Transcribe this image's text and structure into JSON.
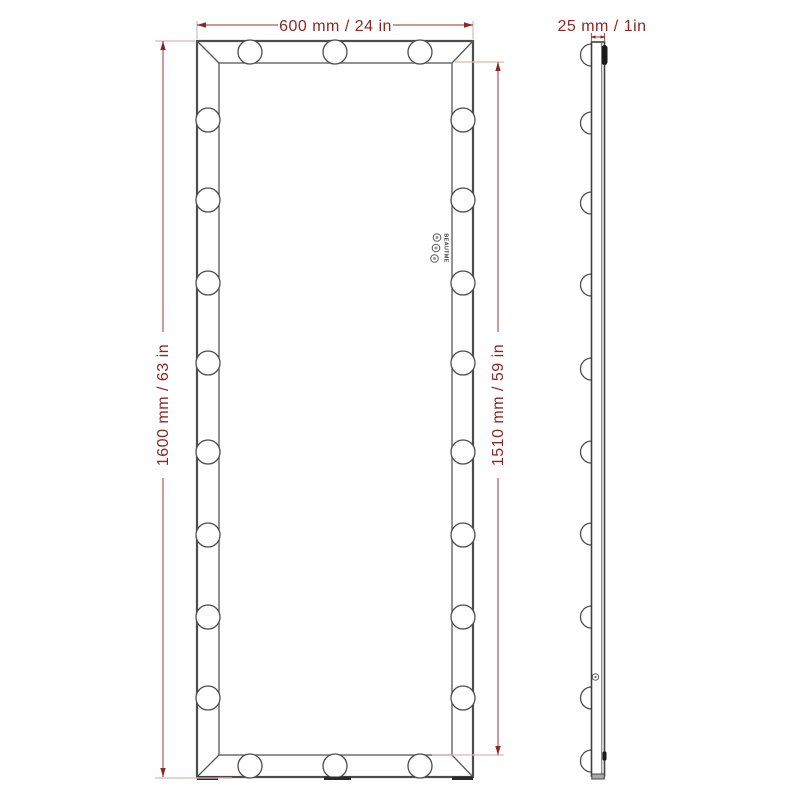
{
  "diagram": {
    "description": "Full-length lighted vanity mirror dimension drawing, front and side views",
    "front_view": {
      "width_label": "600 mm / 24 in",
      "height_label": "1600 mm / 63 in",
      "inner_height_label": "1510 mm / 59 in",
      "brand_label": "BEAUTME",
      "control_button_count": 3,
      "bulbs": {
        "top": 3,
        "bottom": 3,
        "left": 8,
        "right": 8
      }
    },
    "side_view": {
      "depth_label": "25 mm / 1in",
      "bulb_count": 10
    },
    "colors": {
      "dimension_text": "#8e2723",
      "dimension_line": "#ad5a55",
      "extension_line": "#ddb8b4",
      "frame_line": "#4d4d4d",
      "background": "#ffffff"
    }
  }
}
